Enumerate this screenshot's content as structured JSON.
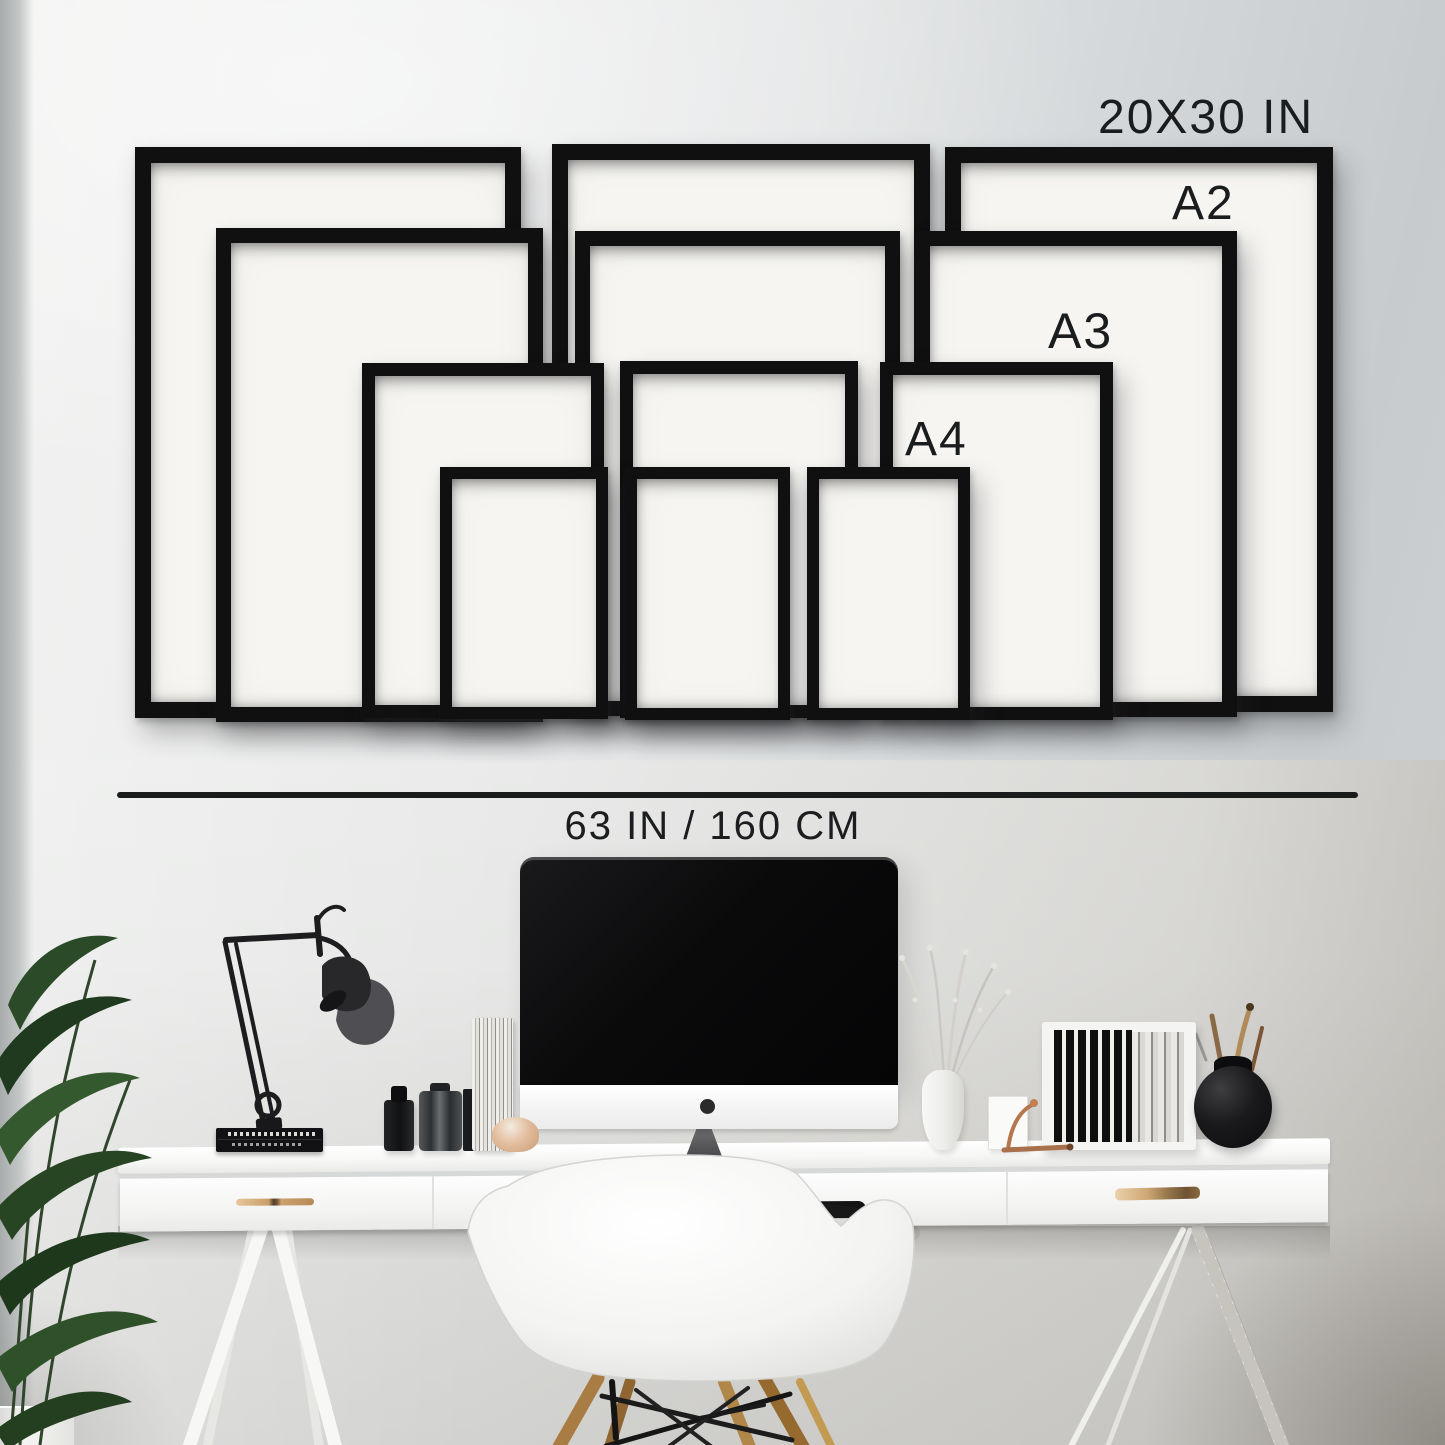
{
  "title": "Frame size guide above desk workspace",
  "size_guide": {
    "labels": {
      "largest_size": "20X30 IN",
      "a2": "A2",
      "a3": "A3",
      "a4": "A4"
    },
    "measurement": {
      "text": "63 IN / 160 CM"
    },
    "colors": {
      "frame": "#101010",
      "paper": "#f6f5f2",
      "text": "#1b1c1d",
      "line": "#1a1b1b"
    },
    "frames": [
      {
        "size": "20x30",
        "position": "left"
      },
      {
        "size": "20x30",
        "position": "center"
      },
      {
        "size": "20x30",
        "position": "right"
      },
      {
        "size": "a2",
        "position": "left"
      },
      {
        "size": "a2",
        "position": "center"
      },
      {
        "size": "a2",
        "position": "right"
      },
      {
        "size": "a3",
        "position": "left"
      },
      {
        "size": "a3",
        "position": "center"
      },
      {
        "size": "a3",
        "position": "right"
      },
      {
        "size": "a4",
        "position": "left"
      },
      {
        "size": "a4",
        "position": "center"
      },
      {
        "size": "a4",
        "position": "right"
      }
    ]
  },
  "workspace": {
    "objects": [
      "potted-plant",
      "desk-lamp",
      "black-books",
      "imac-monitor",
      "white-drawer-desk",
      "trestle-legs",
      "shell-armchair",
      "black-bottle",
      "faceted-jar",
      "paper-stack",
      "ceramic-dish",
      "dried-branch-vase",
      "copper-figurine",
      "file-organizer",
      "sphere-pen-vase"
    ],
    "colors": {
      "desk": "#fafafa",
      "chair": "#f4f4f2",
      "wood_legs": "#a87c42",
      "wall_light": "#f0f0ef",
      "wall_shaded": "#c7cbcd"
    }
  }
}
